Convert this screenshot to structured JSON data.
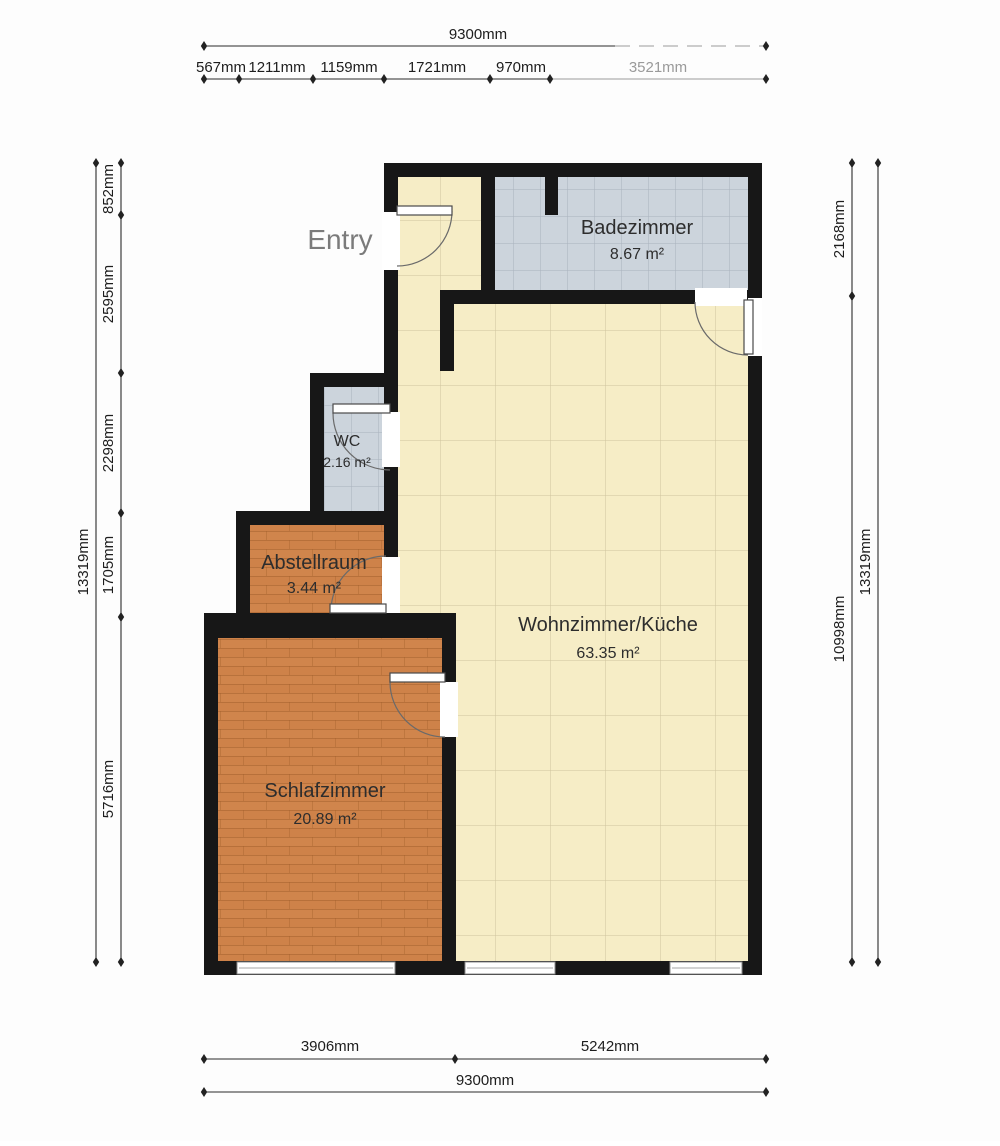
{
  "plan": {
    "entry_label": "Entry",
    "rooms": [
      {
        "name": "Badezimmer",
        "area": "8.67 m²"
      },
      {
        "name": "WC",
        "area": "2.16 m²"
      },
      {
        "name": "Abstellraum",
        "area": "3.44 m²"
      },
      {
        "name": "Wohnzimmer/Küche",
        "area": "63.35 m²"
      },
      {
        "name": "Schlafzimmer",
        "area": "20.89 m²"
      }
    ],
    "colors": {
      "wall": "#171717",
      "tile_floor": "#f6edc6",
      "bath_floor": "#ccd4dc",
      "wood_floor": "#d0854c",
      "dimension_text": "#1d1d1d",
      "entry_text": "#7b7b7b"
    }
  },
  "dimensions": {
    "top": {
      "total": "9300mm",
      "segments": [
        "567mm",
        "1211mm",
        "1159mm",
        "1721mm",
        "970mm",
        "3521mm"
      ]
    },
    "bottom": {
      "total": "9300mm",
      "segments": [
        "3906mm",
        "5242mm"
      ]
    },
    "left": {
      "total": "13319mm",
      "segments": [
        "852mm",
        "2595mm",
        "2298mm",
        "1705mm",
        "5716mm"
      ]
    },
    "right": {
      "total": "13319mm",
      "segments": [
        "2168mm",
        "10998mm"
      ]
    }
  }
}
